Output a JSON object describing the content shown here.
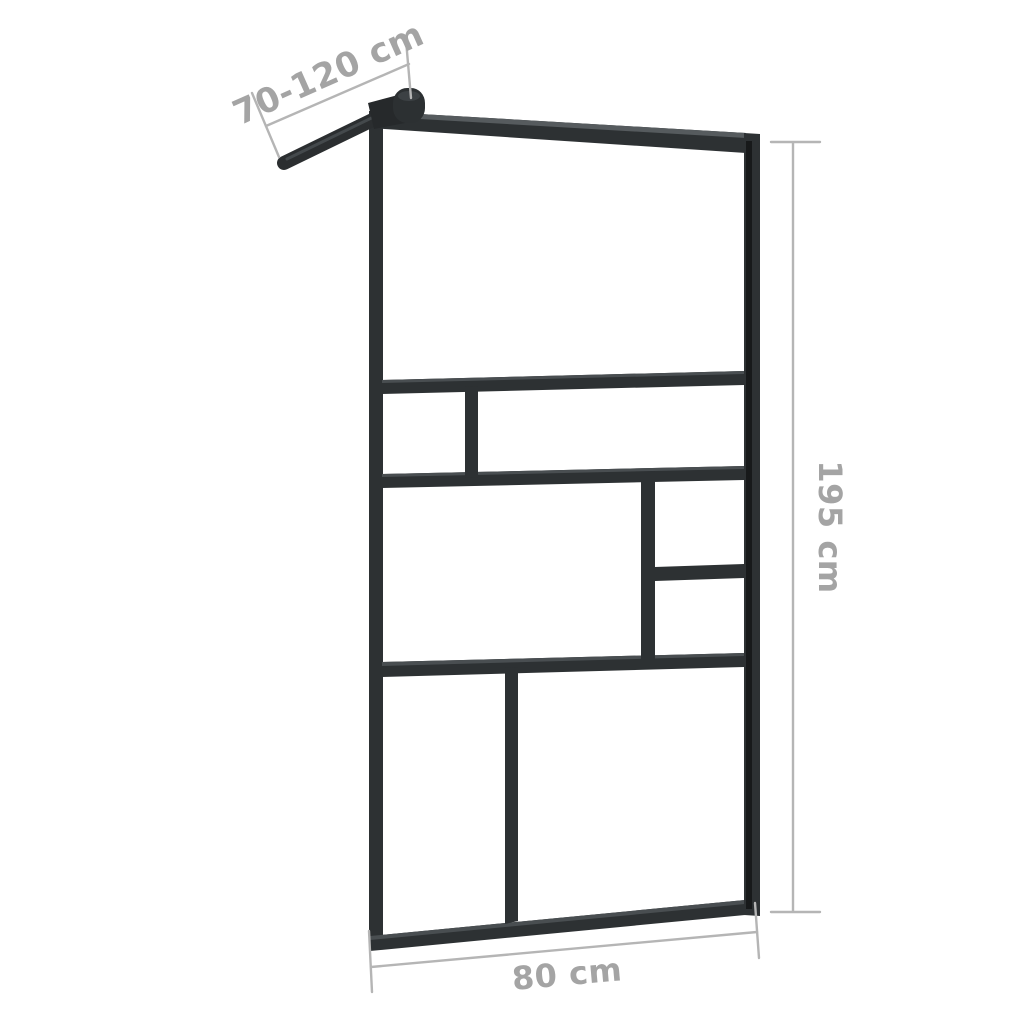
{
  "diagram": {
    "labels": {
      "arm_length": "70-120 cm",
      "height": "195 cm",
      "width": "80 cm"
    },
    "colors": {
      "frame": "#2d3133",
      "frame_highlight": "#565b5e",
      "groove": "#17191a",
      "dimension_lines": "#b5b5b5",
      "dimension_text": "#a4a4a4",
      "background": "#ffffff"
    }
  }
}
